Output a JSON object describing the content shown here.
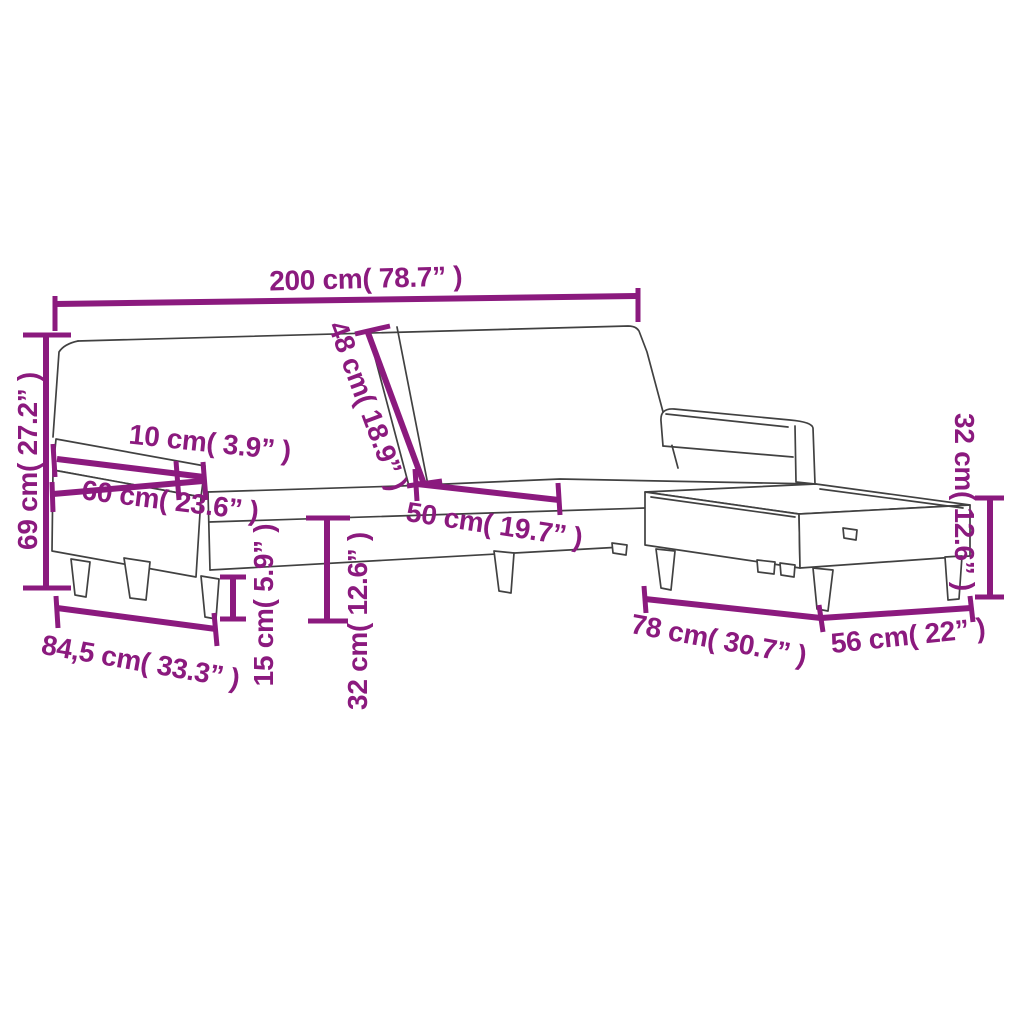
{
  "diagram": {
    "kind": "product-dimension-diagram",
    "subject": "l-shaped-sofa-bed-with-footstool",
    "colors": {
      "accent": "#8B1A7E",
      "outline": "#414141",
      "background": "#FFFFFF"
    },
    "dimensions": [
      {
        "id": "total-width",
        "label": "200 cm( 78.7” )"
      },
      {
        "id": "backrest-height",
        "label": "48 cm( 18.9” )"
      },
      {
        "id": "total-height",
        "label": "69 cm( 27.2” )"
      },
      {
        "id": "armrest-width",
        "label": "10 cm( 3.9” )"
      },
      {
        "id": "armrest-length",
        "label": "60 cm( 23.6” )"
      },
      {
        "id": "seat-depth",
        "label": "50 cm( 19.7” )"
      },
      {
        "id": "footstool-height",
        "label": "32 cm( 12.6” )"
      },
      {
        "id": "total-depth",
        "label": "84,5 cm( 33.3” )"
      },
      {
        "id": "leg-height",
        "label": "15 cm( 5.9” )"
      },
      {
        "id": "seat-height",
        "label": "32 cm( 12.6” )"
      },
      {
        "id": "footstool-length",
        "label": "78 cm( 30.7” )"
      },
      {
        "id": "footstool-width",
        "label": "56 cm( 22” )"
      }
    ]
  }
}
